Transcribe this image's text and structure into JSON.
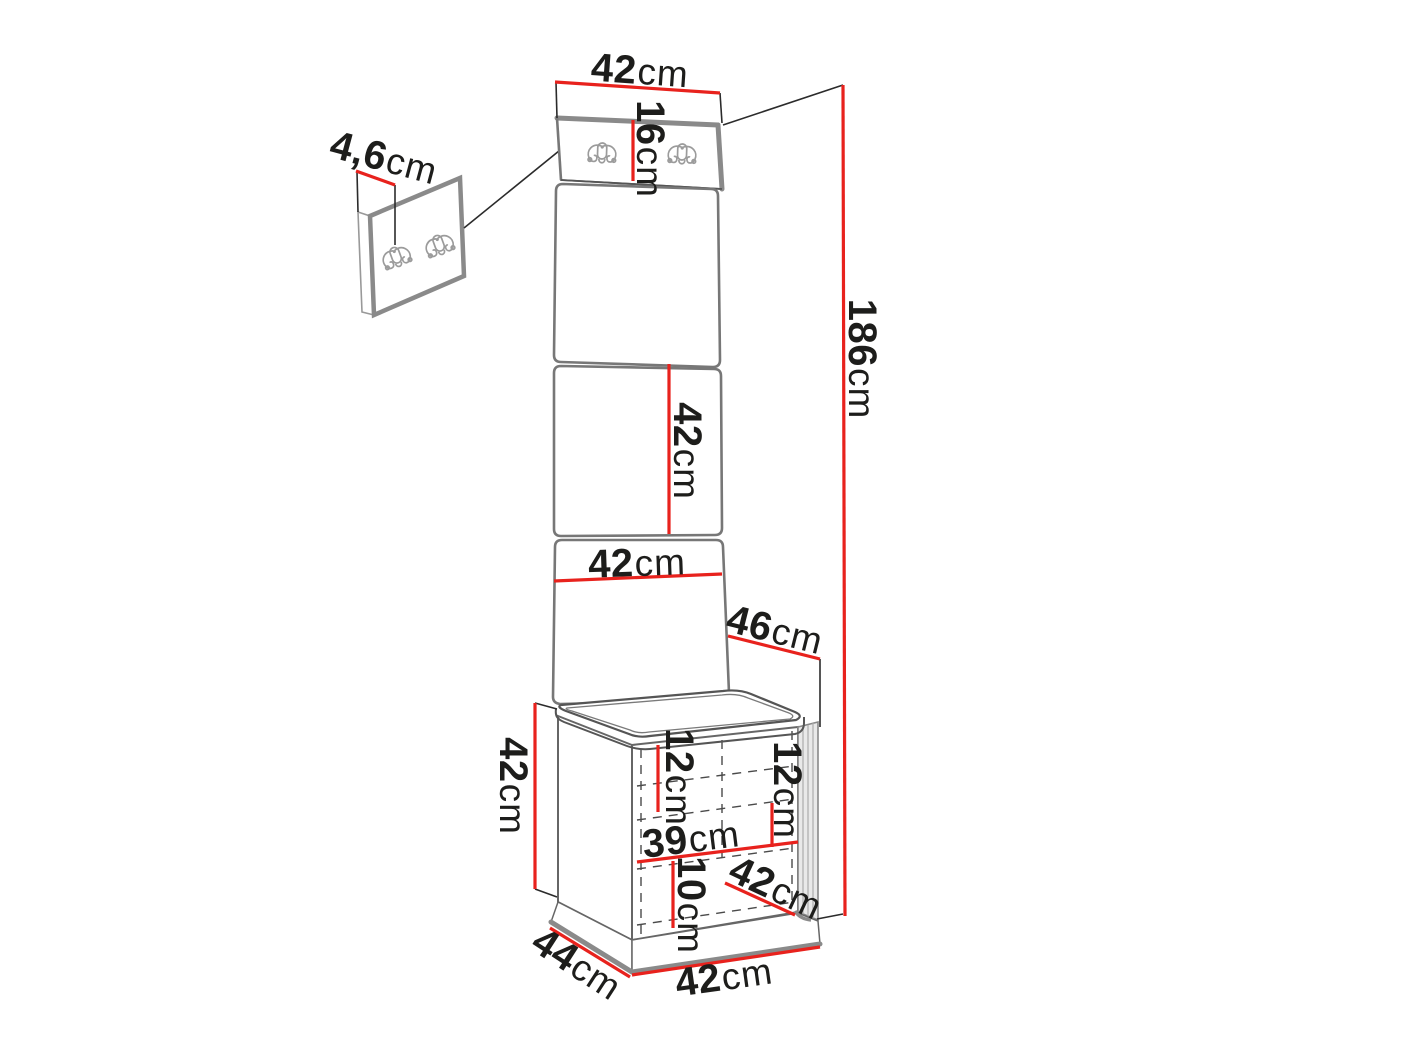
{
  "diagram_title": "Hallway furniture set dimension diagram",
  "colors": {
    "dimension_line": "#e8221d",
    "label_text": "#1d1d1b",
    "outline_gray": "#8a8a8a"
  },
  "unit_label": "cm",
  "dimensions": {
    "panel_top_width": {
      "value": "42",
      "unit": "cm"
    },
    "hook_panel_height": {
      "value": "16",
      "unit": "cm"
    },
    "hook_panel_thickness": {
      "value": "4,6",
      "unit": "cm"
    },
    "mid_panel_height": {
      "value": "42",
      "unit": "cm"
    },
    "panel_width": {
      "value": "42",
      "unit": "cm"
    },
    "total_height": {
      "value": "186",
      "unit": "cm"
    },
    "seat_depth": {
      "value": "46",
      "unit": "cm"
    },
    "bench_height": {
      "value": "42",
      "unit": "cm"
    },
    "compartment_left_height": {
      "value": "12",
      "unit": "cm"
    },
    "compartment_right_height": {
      "value": "12",
      "unit": "cm"
    },
    "shelf_width": {
      "value": "39",
      "unit": "cm"
    },
    "bottom_compartment_height": {
      "value": "10",
      "unit": "cm"
    },
    "door_width": {
      "value": "42",
      "unit": "cm"
    },
    "bench_depth": {
      "value": "44",
      "unit": "cm"
    },
    "bench_width": {
      "value": "42",
      "unit": "cm"
    }
  }
}
